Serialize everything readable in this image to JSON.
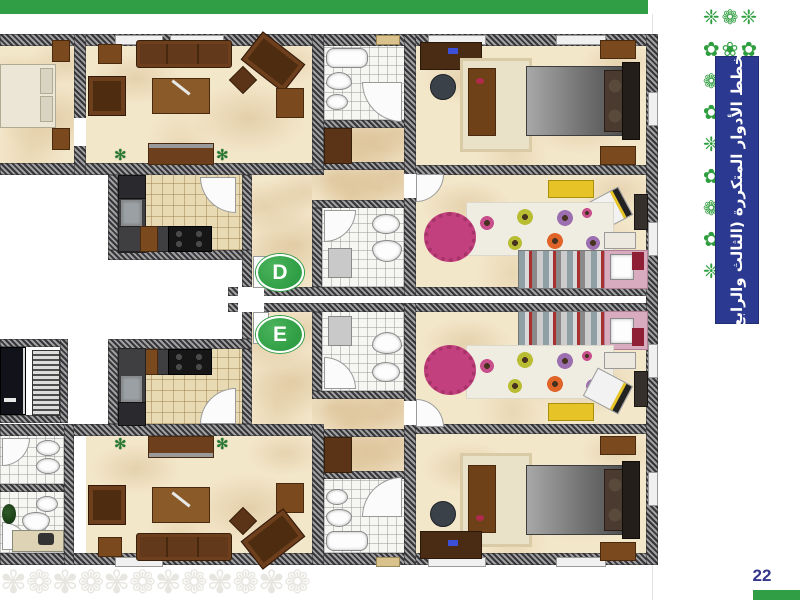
{
  "document": {
    "side_banner_title": "مخطط الأدوار المتكررة (الثالث والرابع)",
    "page_number": "22"
  },
  "plan": {
    "unit_d_label": "D",
    "unit_e_label": "E"
  },
  "colors": {
    "header_bar_green": "#2f9e44",
    "side_ornament_green": "#2f9e3f",
    "banner_blue": "#2b3990",
    "badge_green": "#2f9e44",
    "page_number_blue": "#35358c",
    "wall_hatch_dark": "#35353a",
    "floor_marble_cream": "#f3e7ca",
    "kitchen_tile": "#e8dab3",
    "bathroom_tile": "#f6f6f3",
    "sofa_brown": "#5b3317",
    "bed_gray": "#6c6c6c",
    "kids_pink": "#d9abbe",
    "desk_yellow": "#e6c427"
  },
  "decor": {
    "side_ornament_rows": [
      "❈❁❈",
      "✿❀✿",
      "❁✻❁",
      "✿❀✿",
      "❈❁❈",
      "✿❀✿",
      "❁✻❁",
      "✿❀✿",
      "❈❁❈"
    ],
    "watermark_glyphs": "✾❁✾❁✾❁✾❁✾❁✾❁"
  }
}
